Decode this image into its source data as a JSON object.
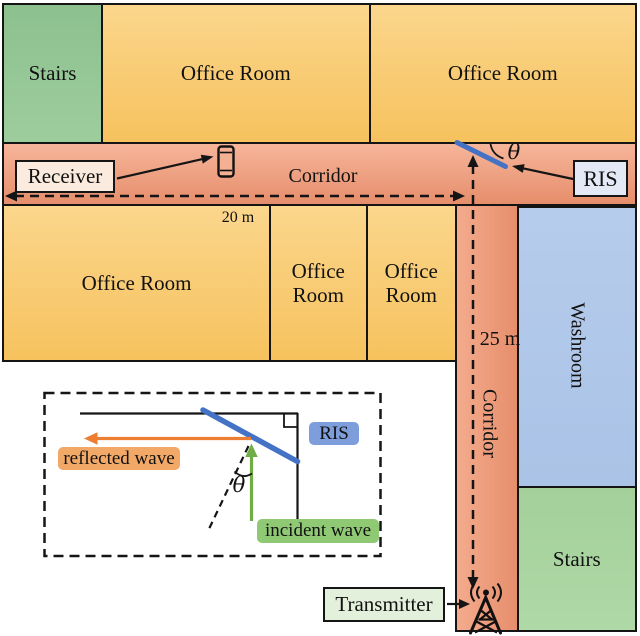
{
  "figure": {
    "rooms": {
      "stairs_top": "Stairs",
      "office_top_left": "Office Room",
      "office_top_right": "Office Room",
      "office_mid_large": "Office Room",
      "office_mid_small_1": "Office Room",
      "office_mid_small_2": "Office Room",
      "washroom": "Washroom",
      "stairs_bottom": "Stairs"
    },
    "corridors": {
      "horizontal": "Corridor",
      "vertical": "Corridor"
    },
    "measurements": {
      "corridor_horizontal_length": "20 m",
      "corridor_vertical_length": "25 m"
    },
    "callouts": {
      "receiver": "Receiver",
      "ris": "RIS",
      "transmitter": "Transmitter",
      "angle": "θ"
    },
    "icons": {
      "receiver_device": "smartphone-icon",
      "transmitter_device": "antenna-broadcast-icon"
    },
    "inset": {
      "reflected_wave_label": "reflected wave",
      "incident_wave_label": "incident wave",
      "ris_label": "RIS",
      "angle_label": "θ"
    },
    "colors": {
      "office_room": "#F8CA6B",
      "corridor": "#EFA081",
      "stairs_top": "#92C393",
      "stairs_bottom": "#A6D39E",
      "washroom": "#AFC7E9",
      "ris_surface_blue": "#4472C4",
      "reflected_wave_orange": "#ED7D31",
      "incident_wave_green": "#70AD47",
      "receiver_box_bg": "#FBEBDE",
      "ris_box_bg": "#E4E9F6",
      "transmitter_box_bg": "#E3F0DB"
    }
  }
}
